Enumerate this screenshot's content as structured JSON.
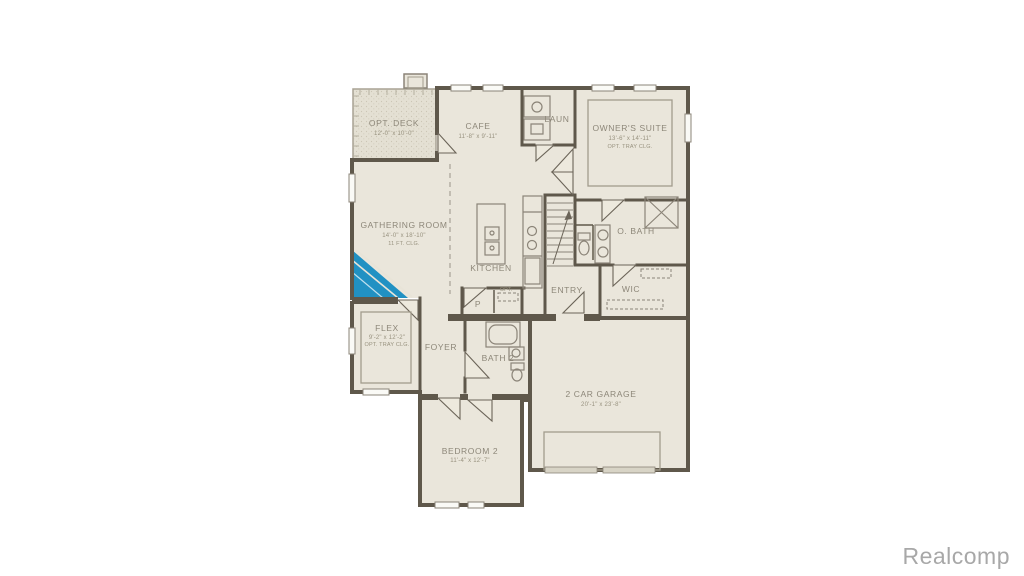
{
  "watermark": {
    "text": "Realcomp"
  },
  "colors": {
    "wall": "#5F584B",
    "floor": "#EAE6DB",
    "deck_floor": "#E4E0D3",
    "accent_blue": "#2191C3",
    "label_gray": "#8D8779",
    "watermark_gray": "#A8A8A8",
    "background": "#FFFFFF"
  },
  "rooms": {
    "deck": {
      "name": "OPT. DECK",
      "dims": "12'-0\" x 10'-0\""
    },
    "cafe": {
      "name": "CAFE",
      "dims": "11'-8\" x 9'-11\""
    },
    "laundry": {
      "name": "LAUN"
    },
    "owners_suite": {
      "name": "OWNER'S SUITE",
      "dims": "13'-6\" x 14'-11\"",
      "note": "OPT. TRAY CLG."
    },
    "gathering": {
      "name": "GATHERING ROOM",
      "dims": "14'-0\" x 18'-10\"",
      "note": "11 FT. CLG."
    },
    "kitchen": {
      "name": "KITCHEN"
    },
    "entry": {
      "name": "ENTRY"
    },
    "owners_bath": {
      "name": "O. BATH"
    },
    "wic": {
      "name": "WIC"
    },
    "flex": {
      "name": "FLEX",
      "dims": "9'-2\" x 12'-2\"",
      "note": "OPT. TRAY CLG."
    },
    "foyer": {
      "name": "FOYER"
    },
    "bath2": {
      "name": "BATH 2"
    },
    "pantry": {
      "name": "P"
    },
    "opt_closet": {
      "name": "OPT."
    },
    "garage": {
      "name": "2 CAR GARAGE",
      "dims": "20'-1\" x 23'-8\""
    },
    "bedroom2": {
      "name": "BEDROOM 2",
      "dims": "11'-4\" x 12'-7\""
    }
  }
}
